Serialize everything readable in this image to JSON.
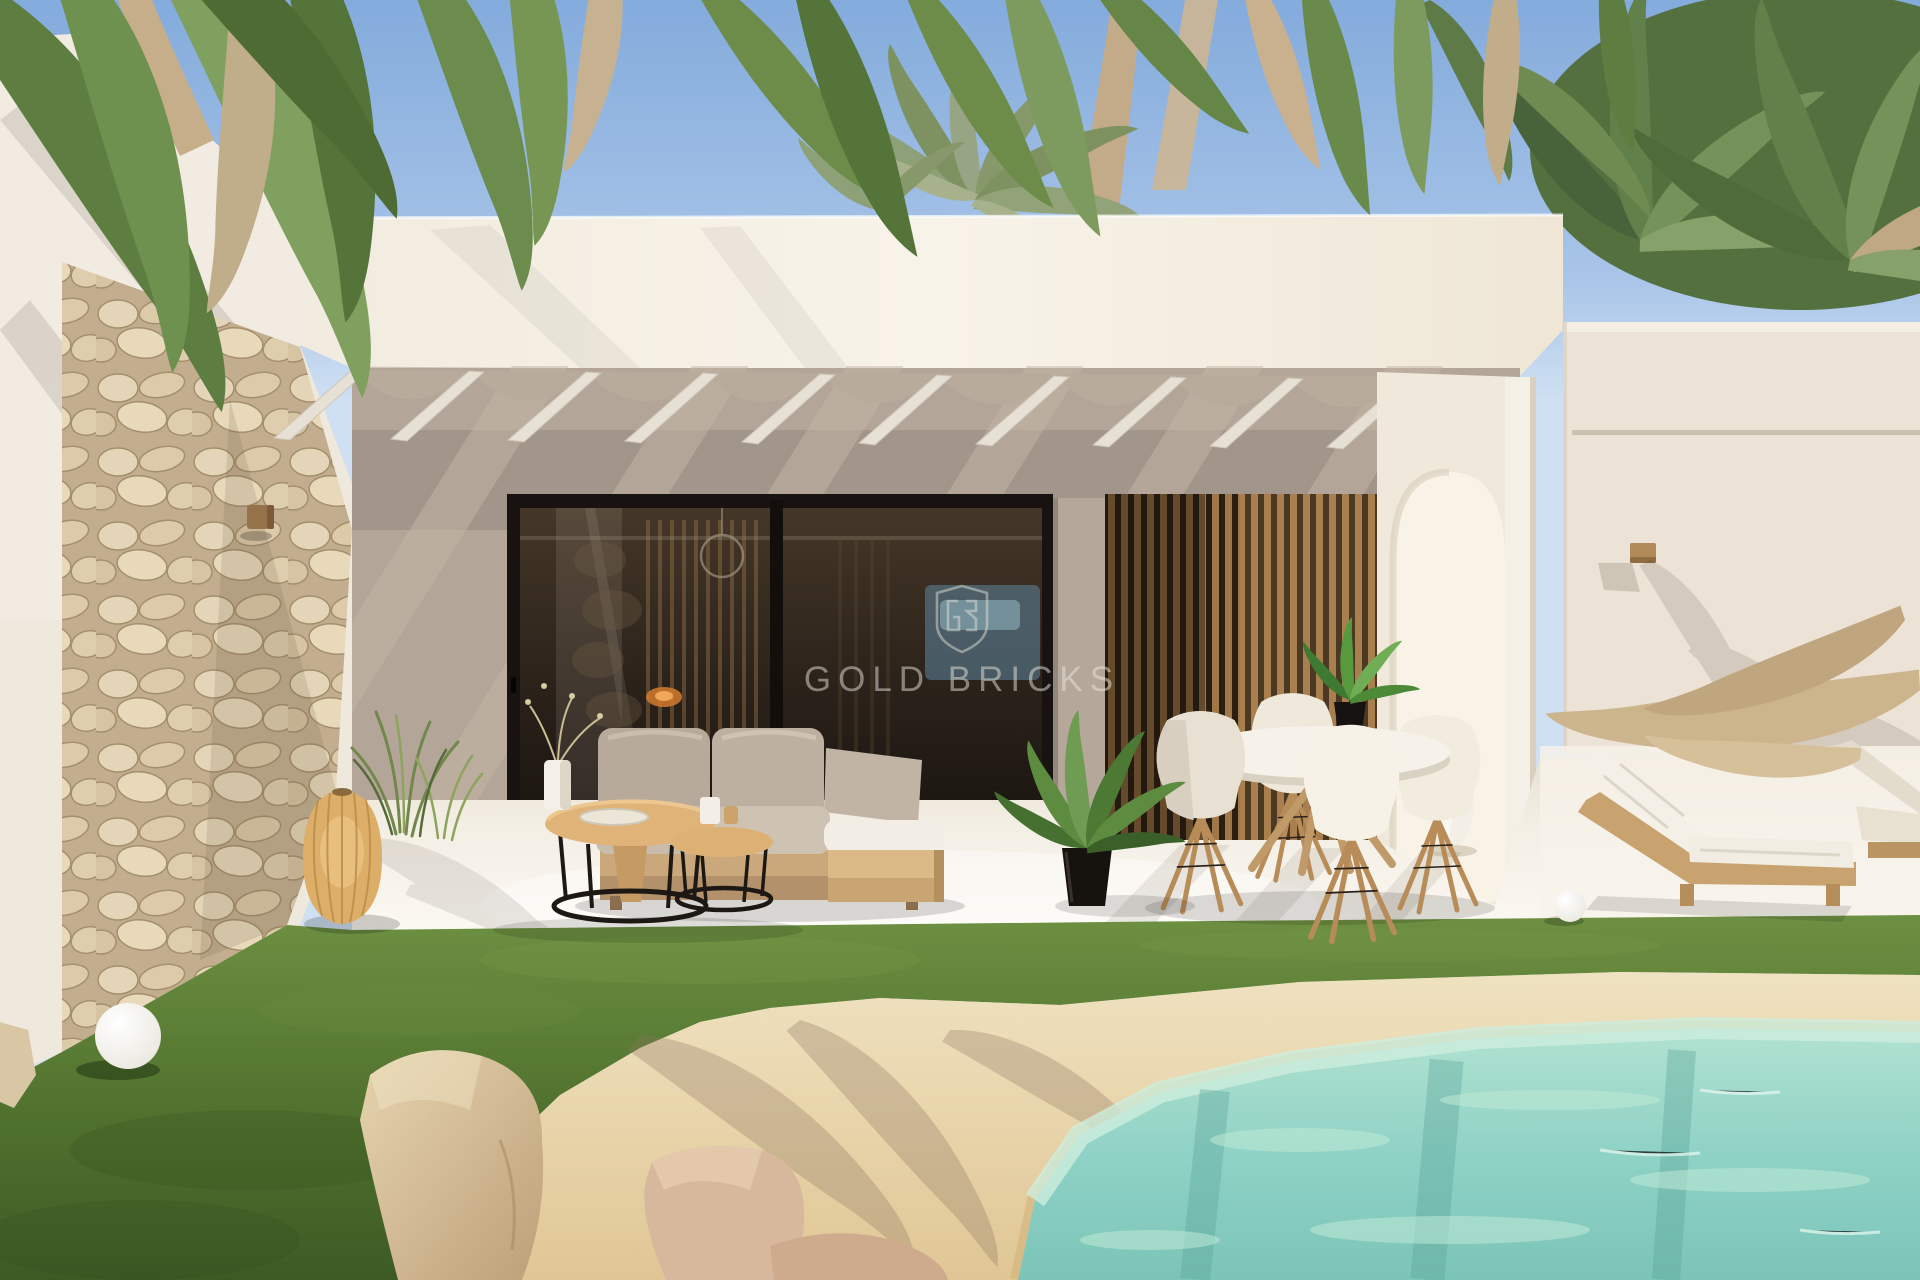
{
  "image": {
    "kind": "3d architectural rendering photo",
    "subject": "Modern white single-storey villa with covered terrace, lawn and sand-edge pool",
    "time_of_day": "sunny daytime"
  },
  "watermark": {
    "text": "GOLD BRICKS",
    "logo": "shield monogram GB",
    "color": "#ece7df"
  },
  "palette": {
    "sky_top": "#83abdc",
    "sky_horizon": "#cfe0f2",
    "wall_bright": "#f6f0e5",
    "wall_cream": "#efe8dd",
    "wall_shadow": "#a5988b",
    "stone_wall": "#d9c8a8",
    "glass_dark": "#2b231d",
    "frame_black": "#17120e",
    "slat_wood": "#a8845a",
    "ceiling_shade": "#a2958a",
    "terrace_floor": "#f6f1e8",
    "lawn_green": "#527231",
    "pool_sand": "#e9d8b0",
    "pool_water": "#8fd2c6",
    "palm_green": "#6a8a4c",
    "palm_dried": "#c3ab89",
    "furniture_wood": "#d9b383",
    "cushion_grey": "#b6a999",
    "cushion_white": "#f2eee5"
  },
  "scene": {
    "vegetation": {
      "overhanging_palms": "palm fronds hang into frame along the top edge",
      "right_canopy": "dense palm crowns behind right roof parapet",
      "center_crown": "palm crown and trunks behind main parapet",
      "ornamental_grass": "grass tufts beside rattan lantern"
    },
    "building": {
      "left_wing": "white wall clad with natural rubble stone, small wood sconce",
      "main_volume": "flat white fascia over covered terrace",
      "pergola": "white angled rafters with scalloped canvas shade",
      "right_wing": "white wall with horizontal groove and wood sconce",
      "arch": "arched opening at right end of terrace with white floor vase",
      "glass_wall": "black-framed sliding glass doors with interior reflections",
      "louver_screen": "vertical wood slat screen"
    },
    "furniture": {
      "sofa": "beige outdoor sofa with chaise and wooden daybed",
      "coffee_tables": "two round nesting tables, wood tops, black wire bases",
      "table_decor": [
        "white vase with dried sprigs",
        "tray",
        "two candles"
      ],
      "dining_set": "round white table, four white shell chairs on wood legs, potted plant on top",
      "floor_plant": "areca palm in black pot",
      "lantern": "woven rattan floor lantern",
      "globe_lamps": [
        "white globe on lawn",
        "small white globe by column"
      ],
      "loungers": "two wooden sun loungers with white cushions"
    },
    "ground": {
      "terrace": "bright white terrace floor with palm and rafter shadows",
      "lawn": "green lawn band",
      "beach_edge": "sandy beach-style pool surround",
      "pool": "turquoise pool water with palm reflections",
      "rocks": "beige and rose boulders at water edge"
    }
  }
}
